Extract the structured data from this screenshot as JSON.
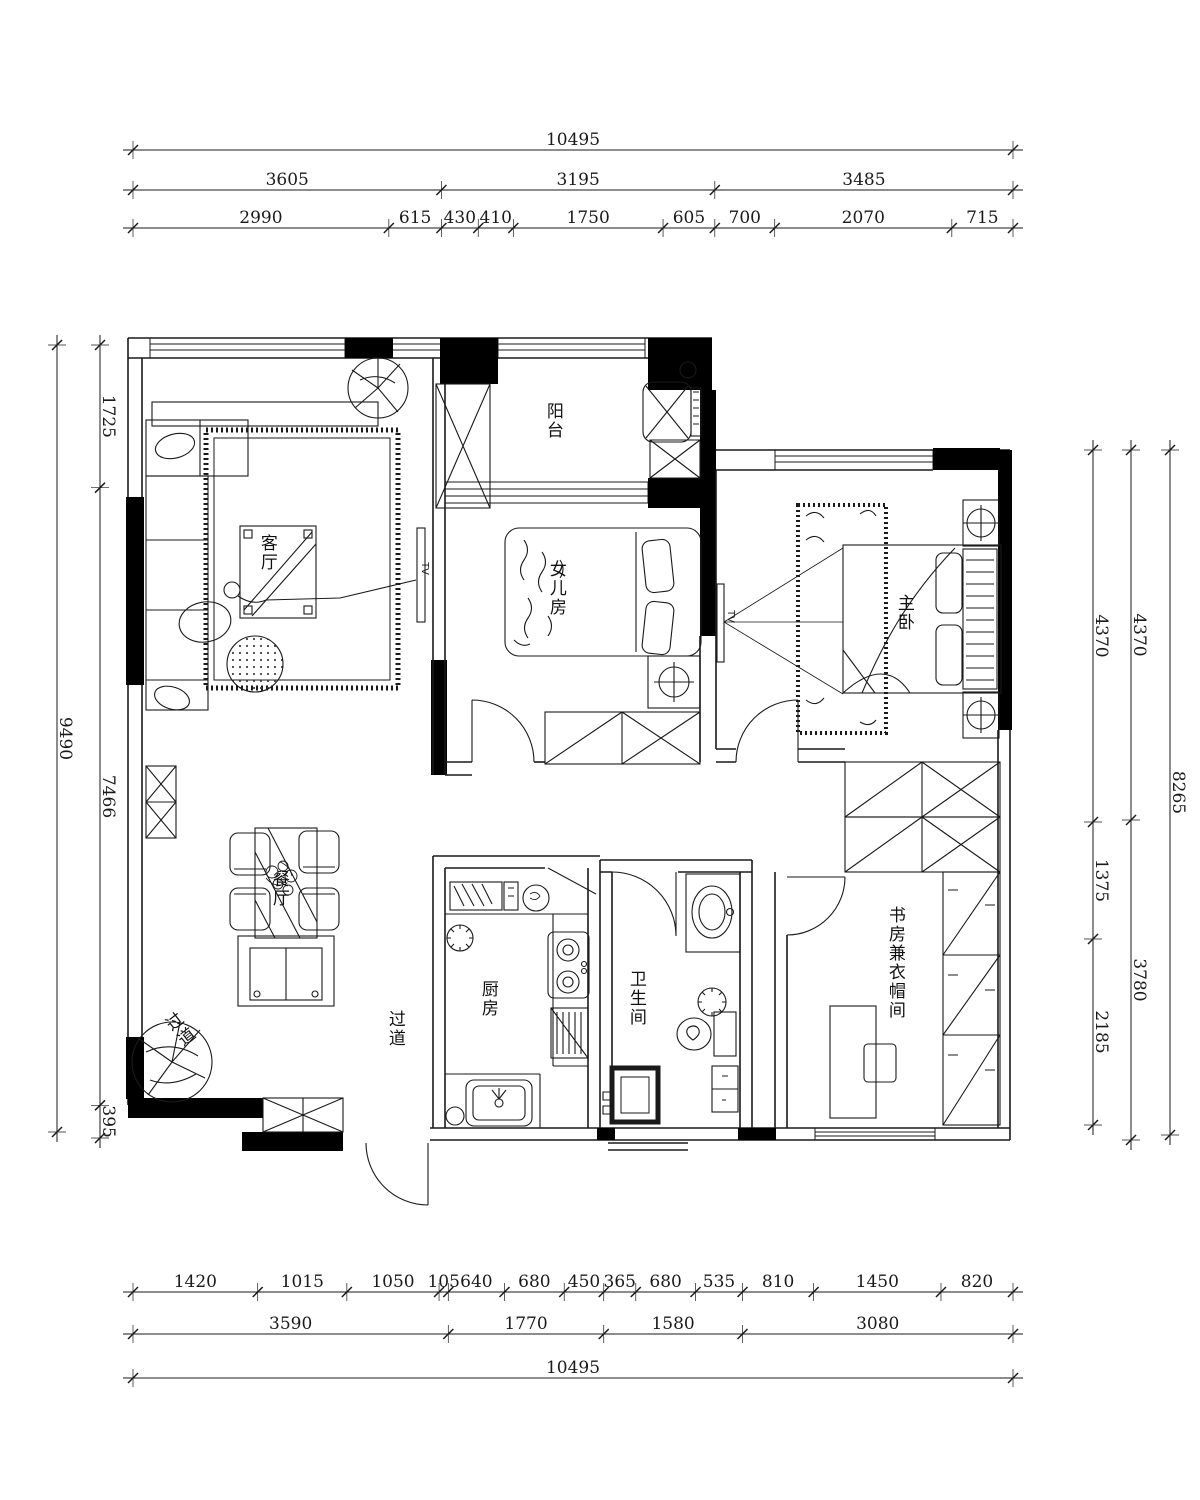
{
  "rooms": {
    "balcony": "阳台",
    "living": "客厅",
    "daughter": "女儿房",
    "master": "主卧",
    "dining": "餐厅",
    "kitchen": "厨房",
    "corridor": "过道",
    "bath": "卫生间",
    "study": "书房兼衣帽间",
    "entry": "过道"
  },
  "annotations": {
    "tv_master": "TV",
    "tv_living": "TV"
  },
  "dims": {
    "top": {
      "total": "10495",
      "mid": [
        "3605",
        "3195",
        "3485"
      ],
      "inner": [
        "2990",
        "615",
        "430",
        "410",
        "1750",
        "605",
        "700",
        "2070",
        "715"
      ]
    },
    "bottom": {
      "inner": [
        "1420",
        "1015",
        "1050",
        "105",
        "640",
        "680",
        "450",
        "365",
        "680",
        "535",
        "810",
        "1450",
        "820"
      ],
      "mid": [
        "3590",
        "1770",
        "1580",
        "3080"
      ],
      "total": "10495"
    },
    "left": {
      "total": "9490",
      "inner": [
        "1725",
        "7466",
        "395"
      ]
    },
    "right": {
      "inner": [
        "4370",
        "1375",
        "2185"
      ],
      "mid": [
        "4370",
        "3780"
      ],
      "total": "8265"
    }
  },
  "colors": {
    "line": "#1a1a1a",
    "wall": "#000000",
    "bg": "#ffffff"
  }
}
